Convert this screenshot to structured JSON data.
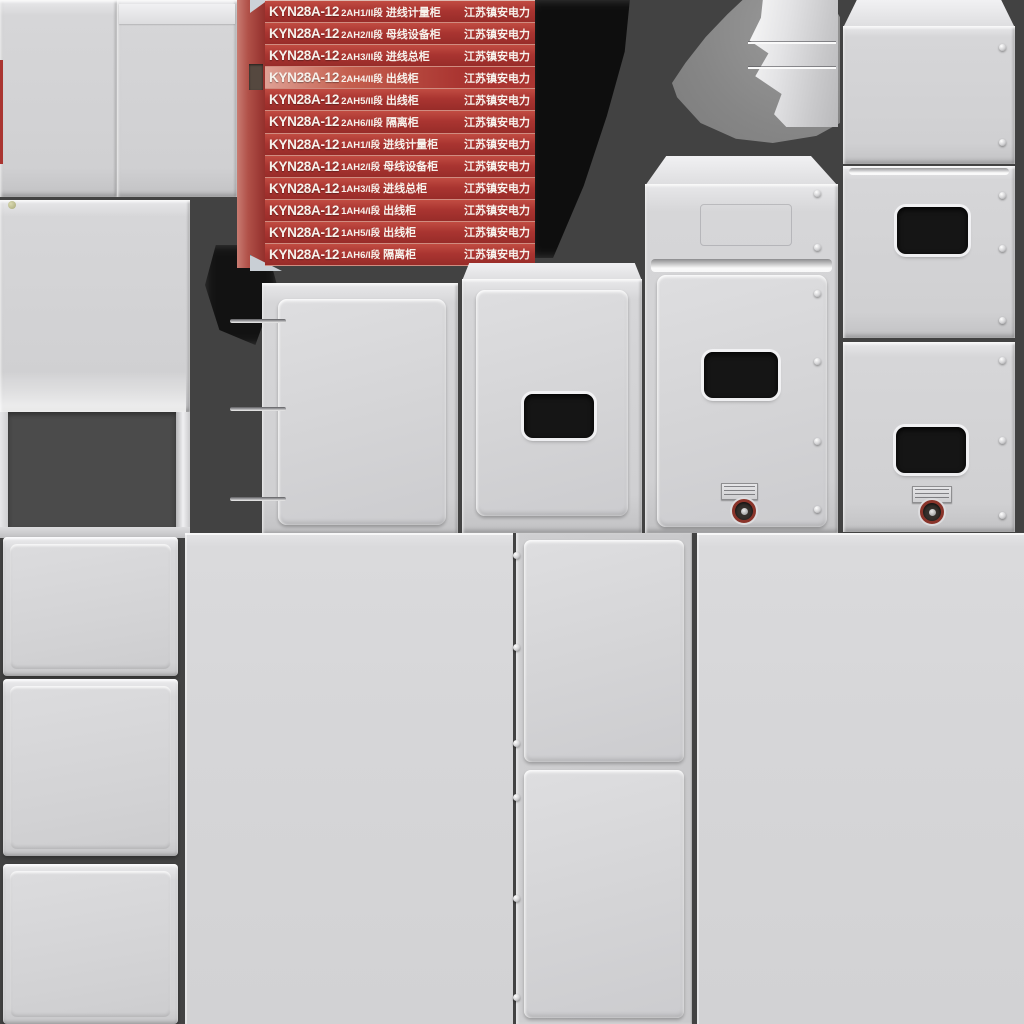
{
  "labels": [
    {
      "model": "KYN28A-12",
      "code": "2AH1/II段",
      "name": "进线计量柜",
      "company": "江苏镇安电力"
    },
    {
      "model": "KYN28A-12",
      "code": "2AH2/II段",
      "name": "母线设备柜",
      "company": "江苏镇安电力"
    },
    {
      "model": "KYN28A-12",
      "code": "2AH3/II段",
      "name": "进线总柜",
      "company": "江苏镇安电力"
    },
    {
      "model": "KYN28A-12",
      "code": "2AH4/II段",
      "name": "出线柜",
      "company": "江苏镇安电力"
    },
    {
      "model": "KYN28A-12",
      "code": "2AH5/II段",
      "name": "出线柜",
      "company": "江苏镇安电力"
    },
    {
      "model": "KYN28A-12",
      "code": "2AH6/II段",
      "name": "隔离柜",
      "company": "江苏镇安电力"
    },
    {
      "model": "KYN28A-12",
      "code": "1AH1/I段",
      "name": "进线计量柜",
      "company": "江苏镇安电力"
    },
    {
      "model": "KYN28A-12",
      "code": "1AH2/I段",
      "name": "母线设备柜",
      "company": "江苏镇安电力"
    },
    {
      "model": "KYN28A-12",
      "code": "1AH3/I段",
      "name": "进线总柜",
      "company": "江苏镇安电力"
    },
    {
      "model": "KYN28A-12",
      "code": "1AH4/I段",
      "name": "出线柜",
      "company": "江苏镇安电力"
    },
    {
      "model": "KYN28A-12",
      "code": "1AH5/I段",
      "name": "出线柜",
      "company": "江苏镇安电力"
    },
    {
      "model": "KYN28A-12",
      "code": "1AH6/I段",
      "name": "隔离柜",
      "company": "江苏镇安电力"
    }
  ],
  "colors": {
    "bg": "#424242",
    "label-red": "#aa3531",
    "label-sep": "#d08c80",
    "label-text": "#f7f2ec",
    "window": "#151515",
    "interior": "#4b4b4b",
    "lock-ring": "#8a342a",
    "plate": "#cfcfd1",
    "shadow": "#0a0a0a"
  }
}
